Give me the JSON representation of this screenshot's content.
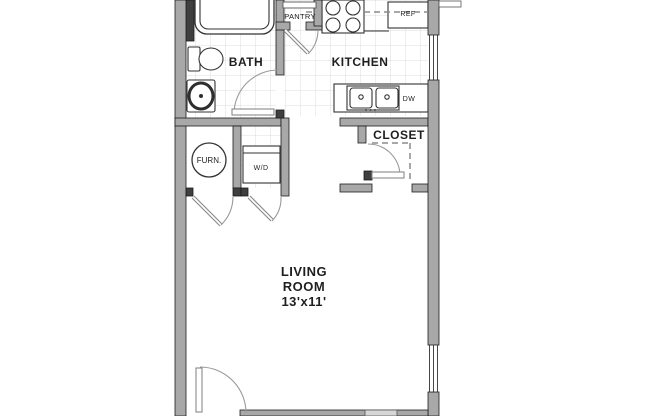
{
  "floor_plan": {
    "rooms": {
      "bath": "BATH",
      "kitchen": "KITCHEN",
      "pantry": "PANTRY",
      "closet": "CLOSET",
      "living_room": {
        "line1": "LIVING",
        "line2": "ROOM",
        "dimensions": "13'x11'"
      }
    },
    "fixtures": {
      "refrigerator": "REF",
      "dishwasher": "DW",
      "washer_dryer": "W/D",
      "furnace": "FURN."
    },
    "colors": {
      "wall": "#a8a8a8",
      "wall_outline": "#1c1c1c",
      "tile_line": "#dcdcdc",
      "door_swing": "#9a9a9a",
      "background": "#ffffff"
    }
  }
}
